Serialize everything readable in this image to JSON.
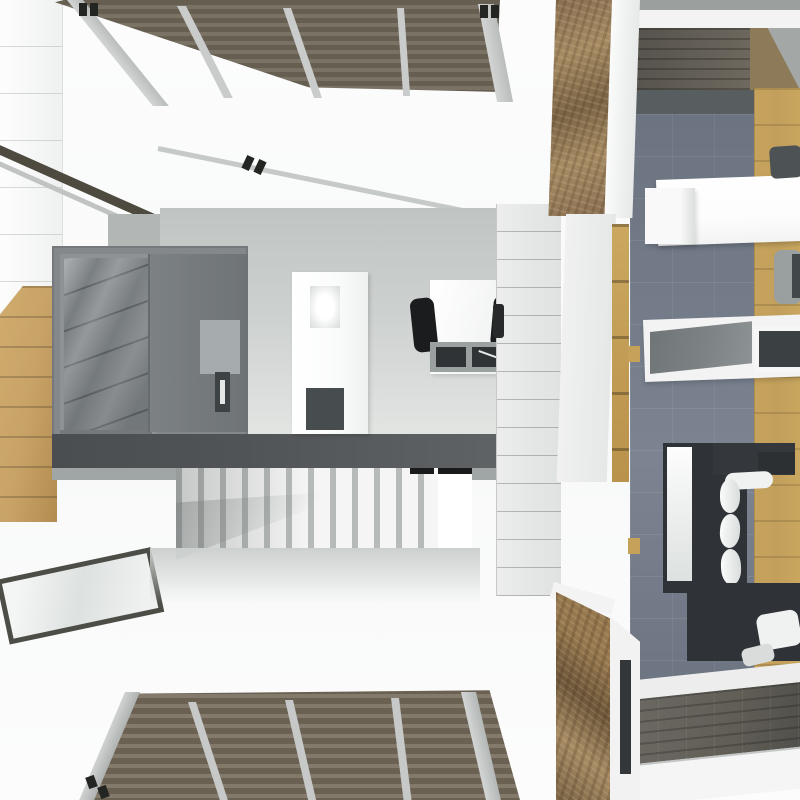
{
  "meta": {
    "view": "top-down 3D architectural render of a modern two-level home interior",
    "canvas_px": "800x800",
    "visible_text": "none"
  },
  "palette": {
    "bg": "#fcfcfd",
    "wall_white": "#f2f3f2",
    "wall_gray": "#b2b6b5",
    "pergola_slat_dark": "#675e52",
    "pergola_slat_light": "#7b7266",
    "pergola_beam": "#c9cccb",
    "deck_slat_dark": "#6b6153",
    "deck_slat_light": "#837a6c",
    "cabinet_gray": "#84888a",
    "cabinet_glass": "#7b8083",
    "appliance_gray": "#a6abad",
    "counter_dark": "#505456",
    "counter_edge": "#a0a5a5",
    "island_white": "#fafbfb",
    "cooktop_dark": "#474c4f",
    "chair_black": "#1b1c1e",
    "stair_tread": "#f4f5f4",
    "stair_gap": "#b6bab9",
    "oak_wood": "#c2a05c",
    "left_wood": "#c8a368",
    "carpet_gray": "#747c8a",
    "entry_wood_dark": "#615e56",
    "stone_tan": "#a68b63",
    "stone_brown": "#7b6546",
    "sofa_charcoal": "#2f3337",
    "pillow_white": "#f0f2f1",
    "table_white": "#fdfdfd",
    "tv_gray": "#7d8284",
    "glass_frame": "#4d4d47",
    "accent_dark": "#232522"
  },
  "scene": {
    "outdoor": {
      "pergola_top": "brown slatted pergola roof over upper terrace with light gray rafters",
      "deck_bottom": "brown slatted pergola roof over lower terrace with light gray rafters",
      "terrace": "white terrace floor",
      "glass_skylight": "dark-framed reflective glass panel set in terrace floor",
      "wood_strip_left": "oak wood floor strip along left edge"
    },
    "kitchen": {
      "cabinets": "gray tall cabinet block with glass display door and open shelf",
      "appliance": "built-in oven with dark handle",
      "island": "white kitchen island with sink and dark cooktop",
      "counter": "dark gray bar counter with light front edge",
      "desk": "white desk with two black chairs and gray shelf unit",
      "paneled_wall": "white paneled partition wall with horizontal seams",
      "staircase": "white staircase descending to lower level"
    },
    "living_room": {
      "entry_top": "dark wood entry floor with open door wedge",
      "carpet": "blue-gray tiled carpet",
      "wood_floor_right": "oak wood flooring band on right side",
      "dining_table": "white dining table with gray chairs",
      "wall_shelf": "white floating wall shelf",
      "tv_console": "white media console with flat gray TV panel and dark inset",
      "sofa": "charcoal L-shaped sectional sofa with white bolster pillows and light side stripe",
      "stone_wall_top": "rustic stone-clad wall at room's upper left",
      "stone_wall_bottom": "rustic stone-clad wall at room's lower left",
      "ladder_shelf": "wooden ladder accent against wall",
      "entry_bottom": "gray-brown plank floor at lower entry",
      "window_frames": "white window/wall frames with dark glazing slots"
    }
  }
}
